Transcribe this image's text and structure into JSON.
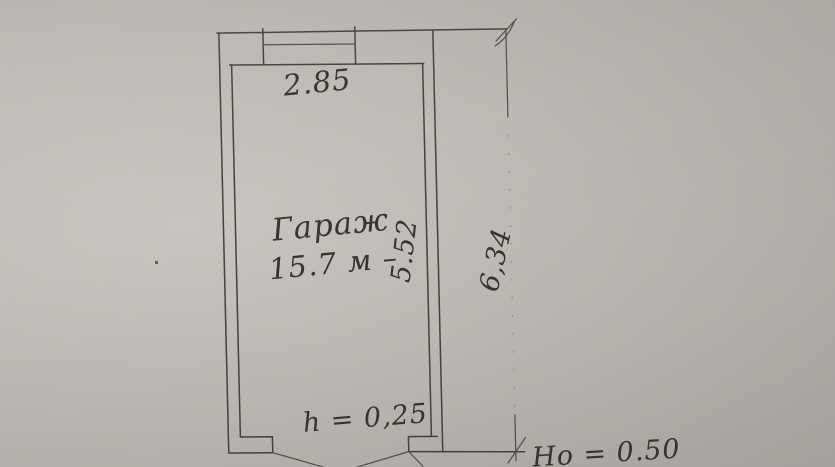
{
  "photo": {
    "paper_color": "#bdb9b4",
    "ink_color": "#454340"
  },
  "plan": {
    "room": {
      "name": "Гараж",
      "area": "15.7 м –"
    },
    "dimensions": {
      "top_width": "2.85",
      "inner_length": "5.52",
      "overall_length": "6,34",
      "threshold_height": "h = 0,25",
      "outer_height": "Но = 0.50"
    }
  }
}
